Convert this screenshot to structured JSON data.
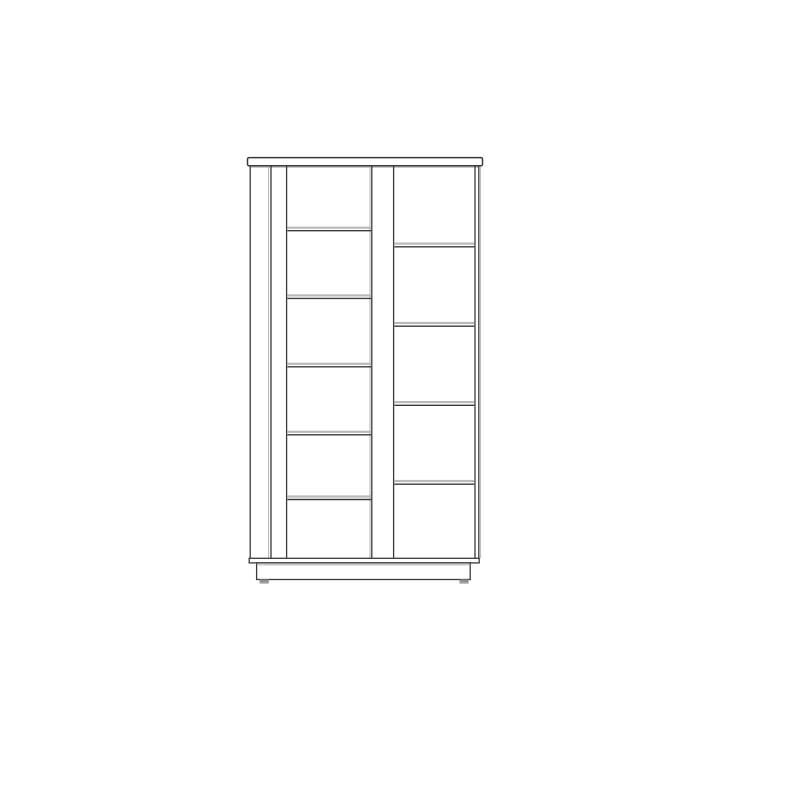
{
  "canvas": {
    "width": 800,
    "height": 800,
    "background": "#ffffff"
  },
  "cabinet": {
    "subject": "front-view technical line drawing of a tall two-bay shelf cabinet with overhanging top board, recessed plinth base and two feet",
    "structure": {
      "left_bay_shelf_count": 5,
      "right_bay_shelf_count": 4,
      "bay_count": 2,
      "has_top_board": true,
      "has_bottom_board": true,
      "has_plinth_base": true,
      "foot_count": 2
    },
    "colors": {
      "dark": "#3a3a3a",
      "light": "#b9b9b9",
      "white": "#ffffff",
      "foot": "#8f8f8f"
    },
    "elements": [
      {
        "kind": "rect",
        "name": "top-board",
        "x": 247.5,
        "y": 157.6,
        "w": 235.0,
        "h": 8.2,
        "rx": 1.5,
        "fill": "white",
        "stroke": "dark",
        "sw": 1.5
      },
      {
        "kind": "line",
        "name": "top-board-shadow",
        "x1": 250.0,
        "y1": 167.2,
        "x2": 479.0,
        "y2": 167.2,
        "stroke": "light",
        "sw": 1.1
      },
      {
        "kind": "line",
        "name": "left-side-panel-edge",
        "x1": 250.2,
        "y1": 166.4,
        "x2": 250.2,
        "y2": 558.3,
        "stroke": "dark",
        "sw": 1.3
      },
      {
        "kind": "line",
        "name": "left-stile-shadow",
        "x1": 268.6,
        "y1": 166.4,
        "x2": 268.6,
        "y2": 558.3,
        "stroke": "light",
        "sw": 1.1
      },
      {
        "kind": "line",
        "name": "left-stile-edge",
        "x1": 271.0,
        "y1": 166.4,
        "x2": 271.0,
        "y2": 558.3,
        "stroke": "dark",
        "sw": 1.3
      },
      {
        "kind": "line",
        "name": "left-bay-left-edge",
        "x1": 286.6,
        "y1": 166.4,
        "x2": 286.6,
        "y2": 558.3,
        "stroke": "dark",
        "sw": 1.3
      },
      {
        "kind": "line",
        "name": "center-divider-shadow",
        "x1": 370.0,
        "y1": 166.4,
        "x2": 370.0,
        "y2": 558.3,
        "stroke": "light",
        "sw": 1.1
      },
      {
        "kind": "line",
        "name": "center-divider-left-edge",
        "x1": 371.8,
        "y1": 166.4,
        "x2": 371.8,
        "y2": 558.3,
        "stroke": "dark",
        "sw": 1.3
      },
      {
        "kind": "line",
        "name": "center-divider-right-edge",
        "x1": 393.6,
        "y1": 166.4,
        "x2": 393.6,
        "y2": 558.3,
        "stroke": "dark",
        "sw": 1.3
      },
      {
        "kind": "line",
        "name": "right-bay-right-edge",
        "x1": 475.0,
        "y1": 166.4,
        "x2": 475.0,
        "y2": 558.3,
        "stroke": "dark",
        "sw": 1.3
      },
      {
        "kind": "line",
        "name": "right-side-panel-edge",
        "x1": 478.8,
        "y1": 166.4,
        "x2": 478.8,
        "y2": 558.3,
        "stroke": "dark",
        "sw": 1.3
      },
      {
        "kind": "line",
        "name": "right-side-shadow",
        "x1": 480.6,
        "y1": 166.4,
        "x2": 480.6,
        "y2": 558.3,
        "stroke": "light",
        "sw": 1.0
      },
      {
        "kind": "rect",
        "name": "left-shelf-1-top",
        "x": 287.4,
        "y": 226.6,
        "w": 83.7,
        "h": 2.2,
        "fill": "light"
      },
      {
        "kind": "line",
        "name": "left-shelf-1-edge",
        "x1": 287.4,
        "y1": 230.7,
        "x2": 371.1,
        "y2": 230.7,
        "stroke": "dark",
        "sw": 1.4
      },
      {
        "kind": "rect",
        "name": "left-shelf-2-top",
        "x": 287.4,
        "y": 294.3,
        "w": 83.7,
        "h": 2.2,
        "fill": "light"
      },
      {
        "kind": "line",
        "name": "left-shelf-2-edge",
        "x1": 287.4,
        "y1": 298.4,
        "x2": 371.1,
        "y2": 298.4,
        "stroke": "dark",
        "sw": 1.4
      },
      {
        "kind": "rect",
        "name": "left-shelf-3-top",
        "x": 287.4,
        "y": 362.7,
        "w": 83.7,
        "h": 2.2,
        "fill": "light"
      },
      {
        "kind": "line",
        "name": "left-shelf-3-edge",
        "x1": 287.4,
        "y1": 366.8,
        "x2": 371.1,
        "y2": 366.8,
        "stroke": "dark",
        "sw": 1.4
      },
      {
        "kind": "rect",
        "name": "left-shelf-4-top",
        "x": 287.4,
        "y": 430.7,
        "w": 83.7,
        "h": 2.2,
        "fill": "light"
      },
      {
        "kind": "line",
        "name": "left-shelf-4-edge",
        "x1": 287.4,
        "y1": 434.8,
        "x2": 371.1,
        "y2": 434.8,
        "stroke": "dark",
        "sw": 1.4
      },
      {
        "kind": "rect",
        "name": "left-shelf-5-top",
        "x": 287.4,
        "y": 495.4,
        "w": 83.7,
        "h": 2.2,
        "fill": "light"
      },
      {
        "kind": "line",
        "name": "left-shelf-5-edge",
        "x1": 287.4,
        "y1": 499.5,
        "x2": 371.1,
        "y2": 499.5,
        "stroke": "dark",
        "sw": 1.4
      },
      {
        "kind": "rect",
        "name": "right-shelf-1-top",
        "x": 394.4,
        "y": 242.5,
        "w": 79.9,
        "h": 2.2,
        "fill": "light"
      },
      {
        "kind": "line",
        "name": "right-shelf-1-edge",
        "x1": 394.4,
        "y1": 246.8,
        "x2": 474.3,
        "y2": 246.8,
        "stroke": "dark",
        "sw": 1.4
      },
      {
        "kind": "rect",
        "name": "right-shelf-2-top",
        "x": 394.4,
        "y": 321.9,
        "w": 79.9,
        "h": 2.2,
        "fill": "light"
      },
      {
        "kind": "line",
        "name": "right-shelf-2-edge",
        "x1": 394.4,
        "y1": 326.2,
        "x2": 474.3,
        "y2": 326.2,
        "stroke": "dark",
        "sw": 1.4
      },
      {
        "kind": "rect",
        "name": "right-shelf-3-top",
        "x": 394.4,
        "y": 401.0,
        "w": 79.9,
        "h": 2.2,
        "fill": "light"
      },
      {
        "kind": "line",
        "name": "right-shelf-3-edge",
        "x1": 394.4,
        "y1": 405.3,
        "x2": 474.3,
        "y2": 405.3,
        "stroke": "dark",
        "sw": 1.4
      },
      {
        "kind": "rect",
        "name": "right-shelf-4-top",
        "x": 394.4,
        "y": 479.9,
        "w": 79.9,
        "h": 2.2,
        "fill": "light"
      },
      {
        "kind": "line",
        "name": "right-shelf-4-edge",
        "x1": 394.4,
        "y1": 484.2,
        "x2": 474.3,
        "y2": 484.2,
        "stroke": "dark",
        "sw": 1.4
      },
      {
        "kind": "rect",
        "name": "bottom-board",
        "x": 249.2,
        "y": 558.3,
        "w": 230.0,
        "h": 4.6,
        "fill": "white",
        "stroke": "dark",
        "sw": 1.3
      },
      {
        "kind": "rect",
        "name": "plinth",
        "x": 256.6,
        "y": 562.9,
        "w": 213.6,
        "h": 16.6,
        "fill": "white",
        "stroke": "dark",
        "sw": 1.3
      },
      {
        "kind": "line",
        "name": "plinth-shadow",
        "x1": 258.0,
        "y1": 564.8,
        "x2": 469.0,
        "y2": 564.8,
        "stroke": "light",
        "sw": 1.1
      },
      {
        "kind": "rect",
        "name": "left-foot",
        "x": 259.6,
        "y": 579.4,
        "w": 9.2,
        "h": 3.4,
        "fill": "foot"
      },
      {
        "kind": "rect",
        "name": "right-foot",
        "x": 459.4,
        "y": 579.4,
        "w": 9.2,
        "h": 3.4,
        "fill": "foot"
      },
      {
        "kind": "line",
        "name": "left-foot-shadow",
        "x1": 259.6,
        "y1": 583.4,
        "x2": 268.8,
        "y2": 583.4,
        "stroke": "light",
        "sw": 1.0
      },
      {
        "kind": "line",
        "name": "right-foot-shadow",
        "x1": 459.4,
        "y1": 583.4,
        "x2": 468.6,
        "y2": 583.4,
        "stroke": "light",
        "sw": 1.0
      }
    ]
  }
}
